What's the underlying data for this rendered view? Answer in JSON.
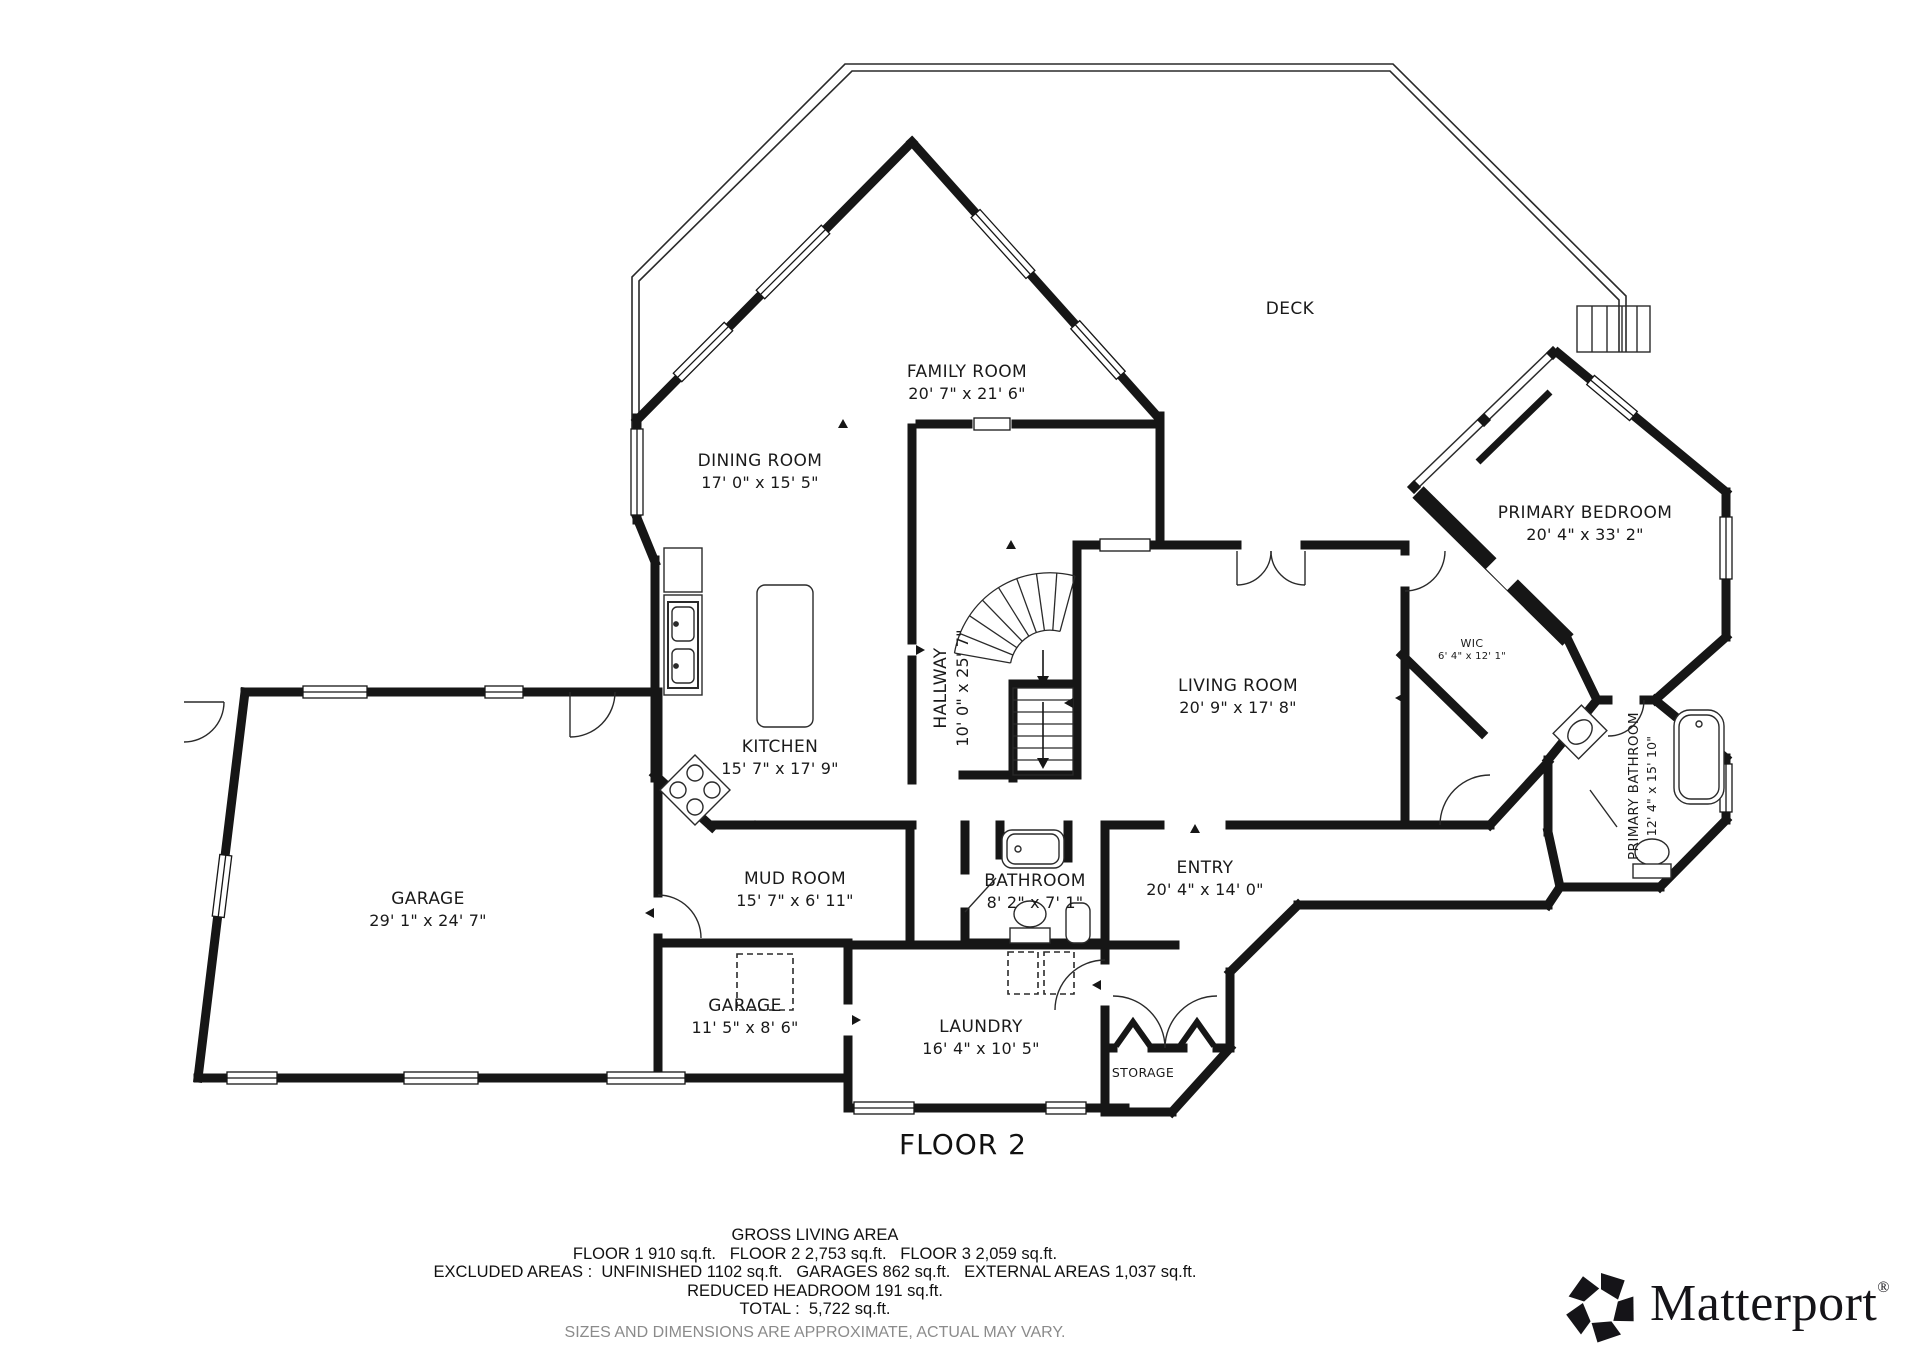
{
  "floor_title": "FLOOR 2",
  "rooms": [
    {
      "name": "FAMILY ROOM",
      "dims": "20' 7\" x 21' 6\""
    },
    {
      "name": "DINING ROOM",
      "dims": "17' 0\" x 15' 5\""
    },
    {
      "name": "KITCHEN",
      "dims": "15' 7\" x 17' 9\""
    },
    {
      "name": "HALLWAY",
      "dims": "10' 0\" x 25' 7\""
    },
    {
      "name": "LIVING ROOM",
      "dims": "20' 9\" x 17' 8\""
    },
    {
      "name": "DECK",
      "dims": ""
    },
    {
      "name": "PRIMARY BEDROOM",
      "dims": "20' 4\" x 33' 2\""
    },
    {
      "name": "WIC",
      "dims": "6' 4\" x 12' 1\""
    },
    {
      "name": "PRIMARY BATHROOM",
      "dims": "12' 4\" x 15' 10\""
    },
    {
      "name": "GARAGE",
      "dims": "29' 1\" x 24' 7\""
    },
    {
      "name": "MUD ROOM",
      "dims": "15' 7\" x 6' 11\""
    },
    {
      "name": "BATHROOM",
      "dims": "8' 2\" x 7' 1\""
    },
    {
      "name": "ENTRY",
      "dims": "20' 4\" x 14' 0\""
    },
    {
      "name": "GARAGE",
      "dims": "11' 5\" x 8' 6\""
    },
    {
      "name": "LAUNDRY",
      "dims": "16' 4\" x 10' 5\""
    },
    {
      "name": "STORAGE",
      "dims": ""
    }
  ],
  "footer": {
    "gross_title": "GROSS LIVING AREA",
    "floors_line": "FLOOR 1 910 sq.ft.   FLOOR 2 2,753 sq.ft.   FLOOR 3 2,059 sq.ft.",
    "excluded_line": "EXCLUDED AREAS :  UNFINISHED 1102 sq.ft.   GARAGES 862 sq.ft.   EXTERNAL AREAS 1,037 sq.ft.",
    "reduced_line": "REDUCED HEADROOM 191 sq.ft.",
    "total_line": "TOTAL :  5,722 sq.ft.",
    "disclaimer": "SIZES AND DIMENSIONS ARE APPROXIMATE, ACTUAL MAY VARY."
  },
  "logo": {
    "text": "Matterport",
    "registered": "®"
  },
  "colors": {
    "wall": "#161616",
    "thin_line": "#2a2a2a",
    "disclaimer_gray": "#8b8b8b",
    "background": "#ffffff"
  }
}
